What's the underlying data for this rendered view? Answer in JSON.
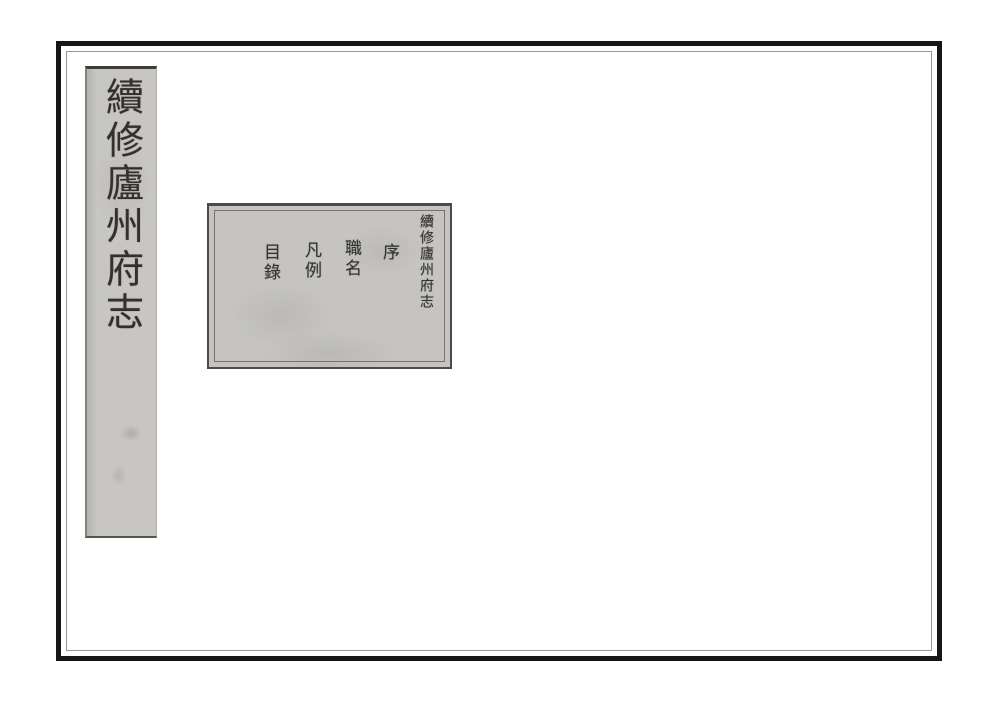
{
  "scan": {
    "background_color": "#ffffff",
    "frame_color": "#161616",
    "inner_rule_color": "#979797",
    "paper_color": "#c6c5c2",
    "ink_color": "#33312c"
  },
  "spine_label": {
    "title": "續修廬州府志"
  },
  "title_page": {
    "book_title": "續修廬州府志",
    "entries": [
      {
        "label": "序"
      },
      {
        "label": "職名"
      },
      {
        "label": "凡例"
      },
      {
        "label": "目錄"
      }
    ]
  }
}
